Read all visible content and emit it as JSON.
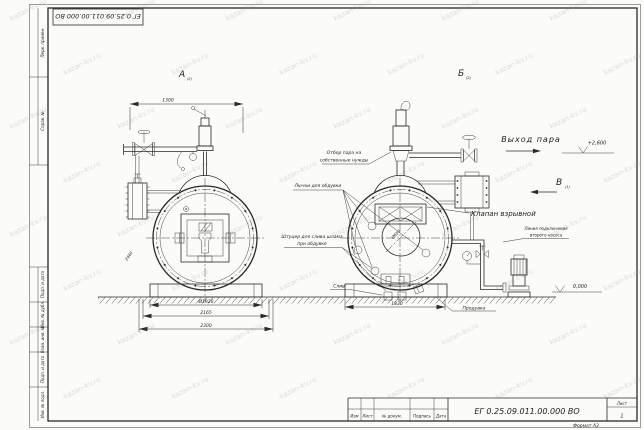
{
  "watermark": {
    "text": "kazan-kv.ru"
  },
  "frame": {
    "left_labels": [
      "Перв. примен.",
      "Справ. №",
      "Подп. и дата",
      "Инв. № дубл.",
      "Взам. инв. №",
      "Подп. и дата",
      "Инв. № подл."
    ],
    "top_stamp_code": "ЕГ 0.25.09.011.00.000  ВО",
    "format_label": "Формат А3"
  },
  "title_block": {
    "doc_number": "ЕГ 0.25.09.011.00.000  ВО",
    "col_izm": "Изм",
    "col_list": "Лист",
    "col_doc": "№ докум.",
    "col_sign": "Подпись",
    "col_date": "Дата",
    "sheet_label": "Лист",
    "sheet_number": "1"
  },
  "views": {
    "a_label": "А",
    "a_ref": "(2)",
    "b_label": "Б",
    "b_ref": "(2)",
    "v_label": "В",
    "v_ref": "(1)"
  },
  "dimensions": {
    "top_width": "1300",
    "shell_dia": "Ø1920",
    "base_mid": "2165",
    "base_out": "2300",
    "flange_dia": "2440",
    "rear_base": "1830",
    "port_dia": "Ø650",
    "elev_steam": "+2,600",
    "elev_zero": "0,000"
  },
  "labels": {
    "steam_out": "Выход пара",
    "explosion_valve": "Клапан взрывной",
    "steam_own_1": "Отбор пара на",
    "steam_own_2": "собственные нужды",
    "hatches": "Лючки для обдувки",
    "sludge_1": "Штуцер для слива шлама",
    "sludge_2": "при обдувке",
    "drain": "Слив",
    "blowdown": "Продувка",
    "pump_line_1": "Линия подключения",
    "pump_line_2": "второго насоса"
  }
}
